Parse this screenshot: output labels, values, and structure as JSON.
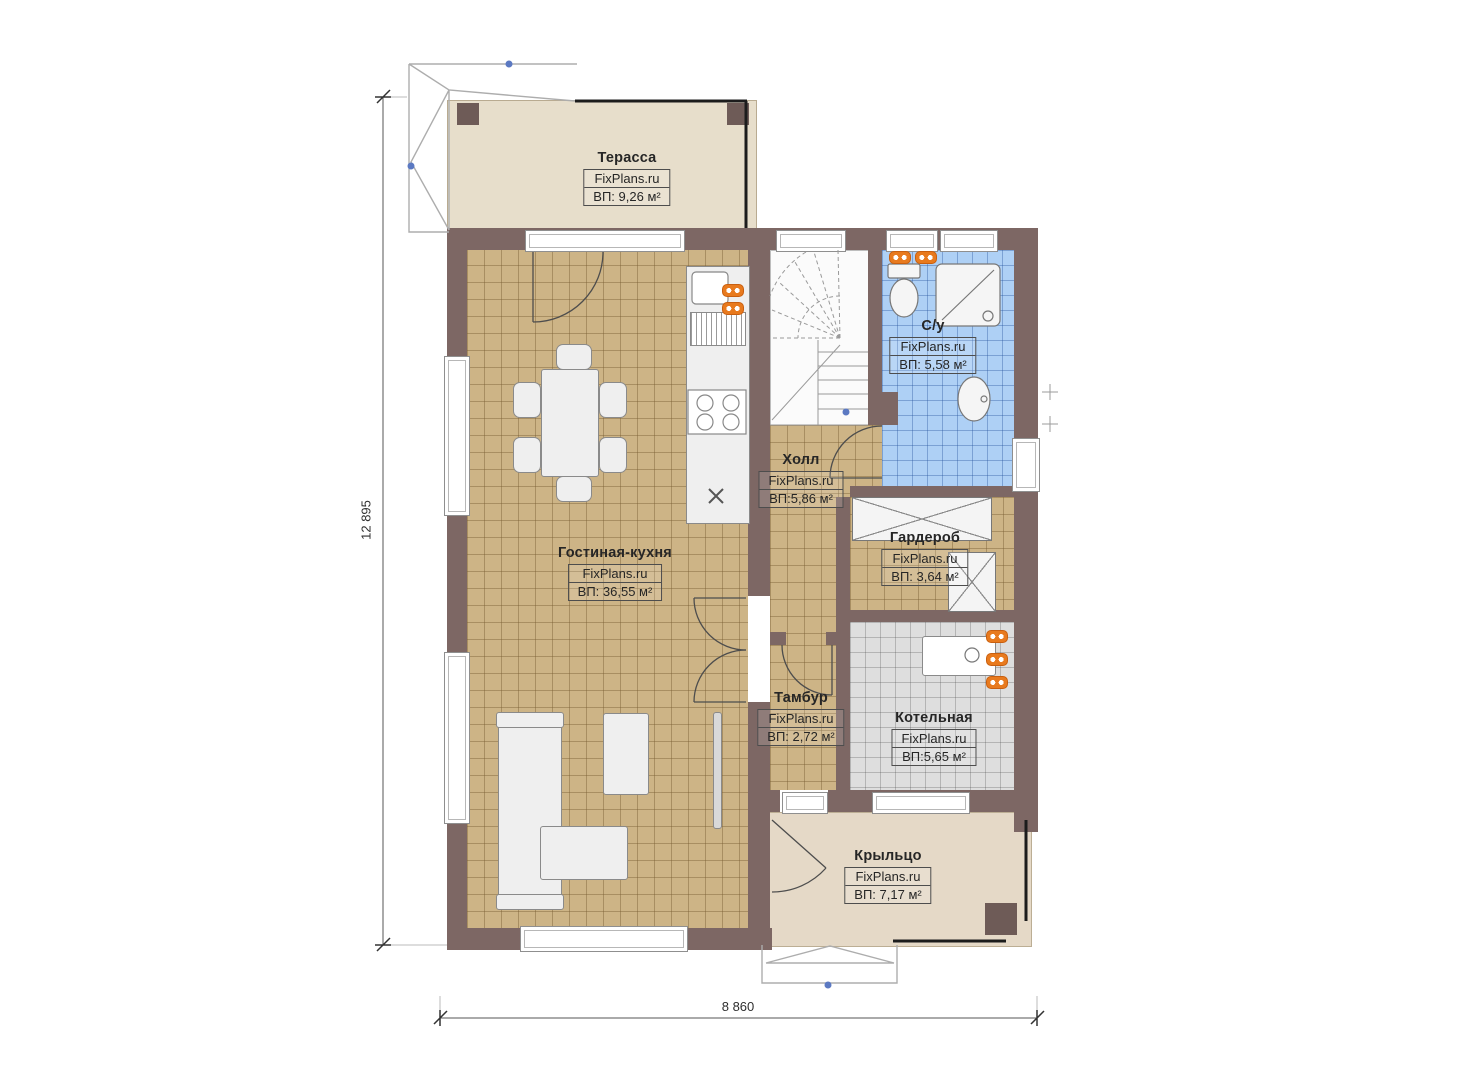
{
  "plan": {
    "site_brand": "FixPlans.ru",
    "dimensions": {
      "height_mm": "12 895",
      "width_mm": "8 860"
    },
    "rooms": [
      {
        "key": "terrace",
        "name": "Терасса",
        "brand": "FixPlans.ru",
        "area": "ВП: 9,26 м²"
      },
      {
        "key": "bathroom",
        "name": "С/у",
        "brand": "FixPlans.ru",
        "area": "ВП: 5,58 м²"
      },
      {
        "key": "hall",
        "name": "Холл",
        "brand": "FixPlans.ru",
        "area": "ВП:5,86 м²"
      },
      {
        "key": "wardrobe",
        "name": "Гардероб",
        "brand": "FixPlans.ru",
        "area": "ВП: 3,64 м²"
      },
      {
        "key": "living_kitchen",
        "name": "Гостиная-кухня",
        "brand": "FixPlans.ru",
        "area": "ВП: 36,55 м²"
      },
      {
        "key": "vestibule",
        "name": "Тамбур",
        "brand": "FixPlans.ru",
        "area": "ВП: 2,72 м²"
      },
      {
        "key": "boiler",
        "name": "Котельная",
        "brand": "FixPlans.ru",
        "area": "ВП:5,65 м²"
      },
      {
        "key": "porch",
        "name": "Крыльцо",
        "brand": "FixPlans.ru",
        "area": "ВП: 7,17 м²"
      }
    ],
    "colors": {
      "wall": "#7d6764",
      "floor_tan": "#cdb486",
      "floor_blue": "#aed0f5",
      "floor_gray": "#dedede",
      "terrace_floor": "#e7decb",
      "porch_floor": "#e5d9c7",
      "radiator_orange": "#e87a1e"
    }
  }
}
